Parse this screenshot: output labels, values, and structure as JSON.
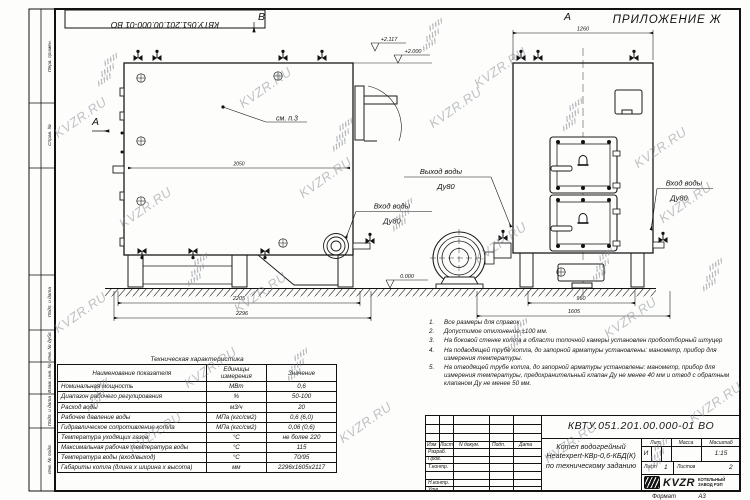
{
  "sheet": {
    "appendix": "ПРИЛОЖЕНИЕ Ж",
    "doc_number_top": "КВТУ.051.201.00.000-01 ВО",
    "watermark": "KVZR.RU",
    "format_label": "Формат",
    "format_value": "А3"
  },
  "stamp_column": {
    "cells": [
      "Перв. примен.",
      "Справ. №",
      "Подп. и дата",
      "Инв. № дубл.",
      "Взам. инв. №",
      "Подп. и дата",
      "Инв. № подл."
    ]
  },
  "drawing": {
    "view_b": "В",
    "view_a_side": "А",
    "view_a_front": "А",
    "callout": "см. п.3",
    "elev_top": "+2.117",
    "elev_body": "+2.000",
    "elev_zero": "0.000",
    "dim_side_inner": "2050",
    "dim_side_base": "2205",
    "dim_side_total": "2296",
    "dim_front_top": "1260",
    "dim_front_base": "960",
    "dim_front_total": "1605",
    "outlet_label": "Выход воды",
    "outlet_dn": "Ду80",
    "inlet_label": "Вход воды",
    "inlet_dn": "Ду80",
    "inlet_front_label": "Вход воды",
    "inlet_front_dn": "Ду80"
  },
  "notes": {
    "items": [
      {
        "num": "1.",
        "text": "Все размеры для справок"
      },
      {
        "num": "2.",
        "text": "Допустимое отклонение  ±100 мм."
      },
      {
        "num": "3.",
        "text": "На боковой стенке котла в области топочной камеры установлен пробоотборный штуцер"
      },
      {
        "num": "4.",
        "text": "На  подводящей трубе котла, до запорной арматуры установлены: манометр, прибор для измерения температуры."
      },
      {
        "num": "5.",
        "text": "На отводящей трубе котла, до запорной арматуры установлены: манометр, прибор для измерения температуры, предохранительный клапан Ду не менее 40 мм и отвод с обратным клапаном Ду не менее 50 мм."
      }
    ]
  },
  "spec_table": {
    "title": "Техническая характеристика",
    "col_name": "Наименование показателя",
    "col_unit": "Единицы измерения",
    "col_value": "Значение",
    "rows": [
      {
        "name": "Номинальная мощность",
        "unit": "МВт",
        "value": "0,6"
      },
      {
        "name": "Диапазон рабочего регулирования",
        "unit": "%",
        "value": "50-100"
      },
      {
        "name": "Расход воды",
        "unit": "м3/ч",
        "value": "20"
      },
      {
        "name": "Рабочее давление воды",
        "unit": "МПа (кгс/см2)",
        "value": "0,6 (6,0)"
      },
      {
        "name": "Гидравлическое сопротивление котла",
        "unit": "МПа (кгс/см2)",
        "value": "0,06 (0,6)"
      },
      {
        "name": "Температура уходящих газов",
        "unit": "°С",
        "value": "не более 220"
      },
      {
        "name": "Максимальная рабочая температура воды",
        "unit": "°С",
        "value": "115"
      },
      {
        "name": "Температура воды (вход/выход)",
        "unit": "°С",
        "value": "70/95"
      },
      {
        "name": "Габариты котла (длина х ширина х высота)",
        "unit": "мм",
        "value": "2296х1605х2117"
      }
    ]
  },
  "title_block": {
    "doc_number": "КВТУ.051.201.00.000-01 ВО",
    "product_line1": "Котел водогрейный",
    "product_line2": "Heatexpert-КВр-0,6-КБД(К)",
    "product_line3": "по техническому заданию",
    "col_izm": "Изм",
    "col_list": "Лист",
    "col_doc": "N докум.",
    "col_podp": "Подп.",
    "col_data": "Дата",
    "rows": [
      "Разраб.",
      "Пров.",
      "Т.контр.",
      "Н.контр.",
      "Утв."
    ],
    "lit_label": "Лит.",
    "lit_value": "И",
    "mass_label": "Масса",
    "scale_label": "Масштаб",
    "scale_value": "1:15",
    "sheet_label": "Лист",
    "sheet_value": "1",
    "sheets_label": "Листов",
    "sheets_value": "2",
    "brand": "KVZR",
    "brand_line1": "КОТЕЛЬНЫЙ",
    "brand_line2": "ЗАВОД РЭП"
  }
}
